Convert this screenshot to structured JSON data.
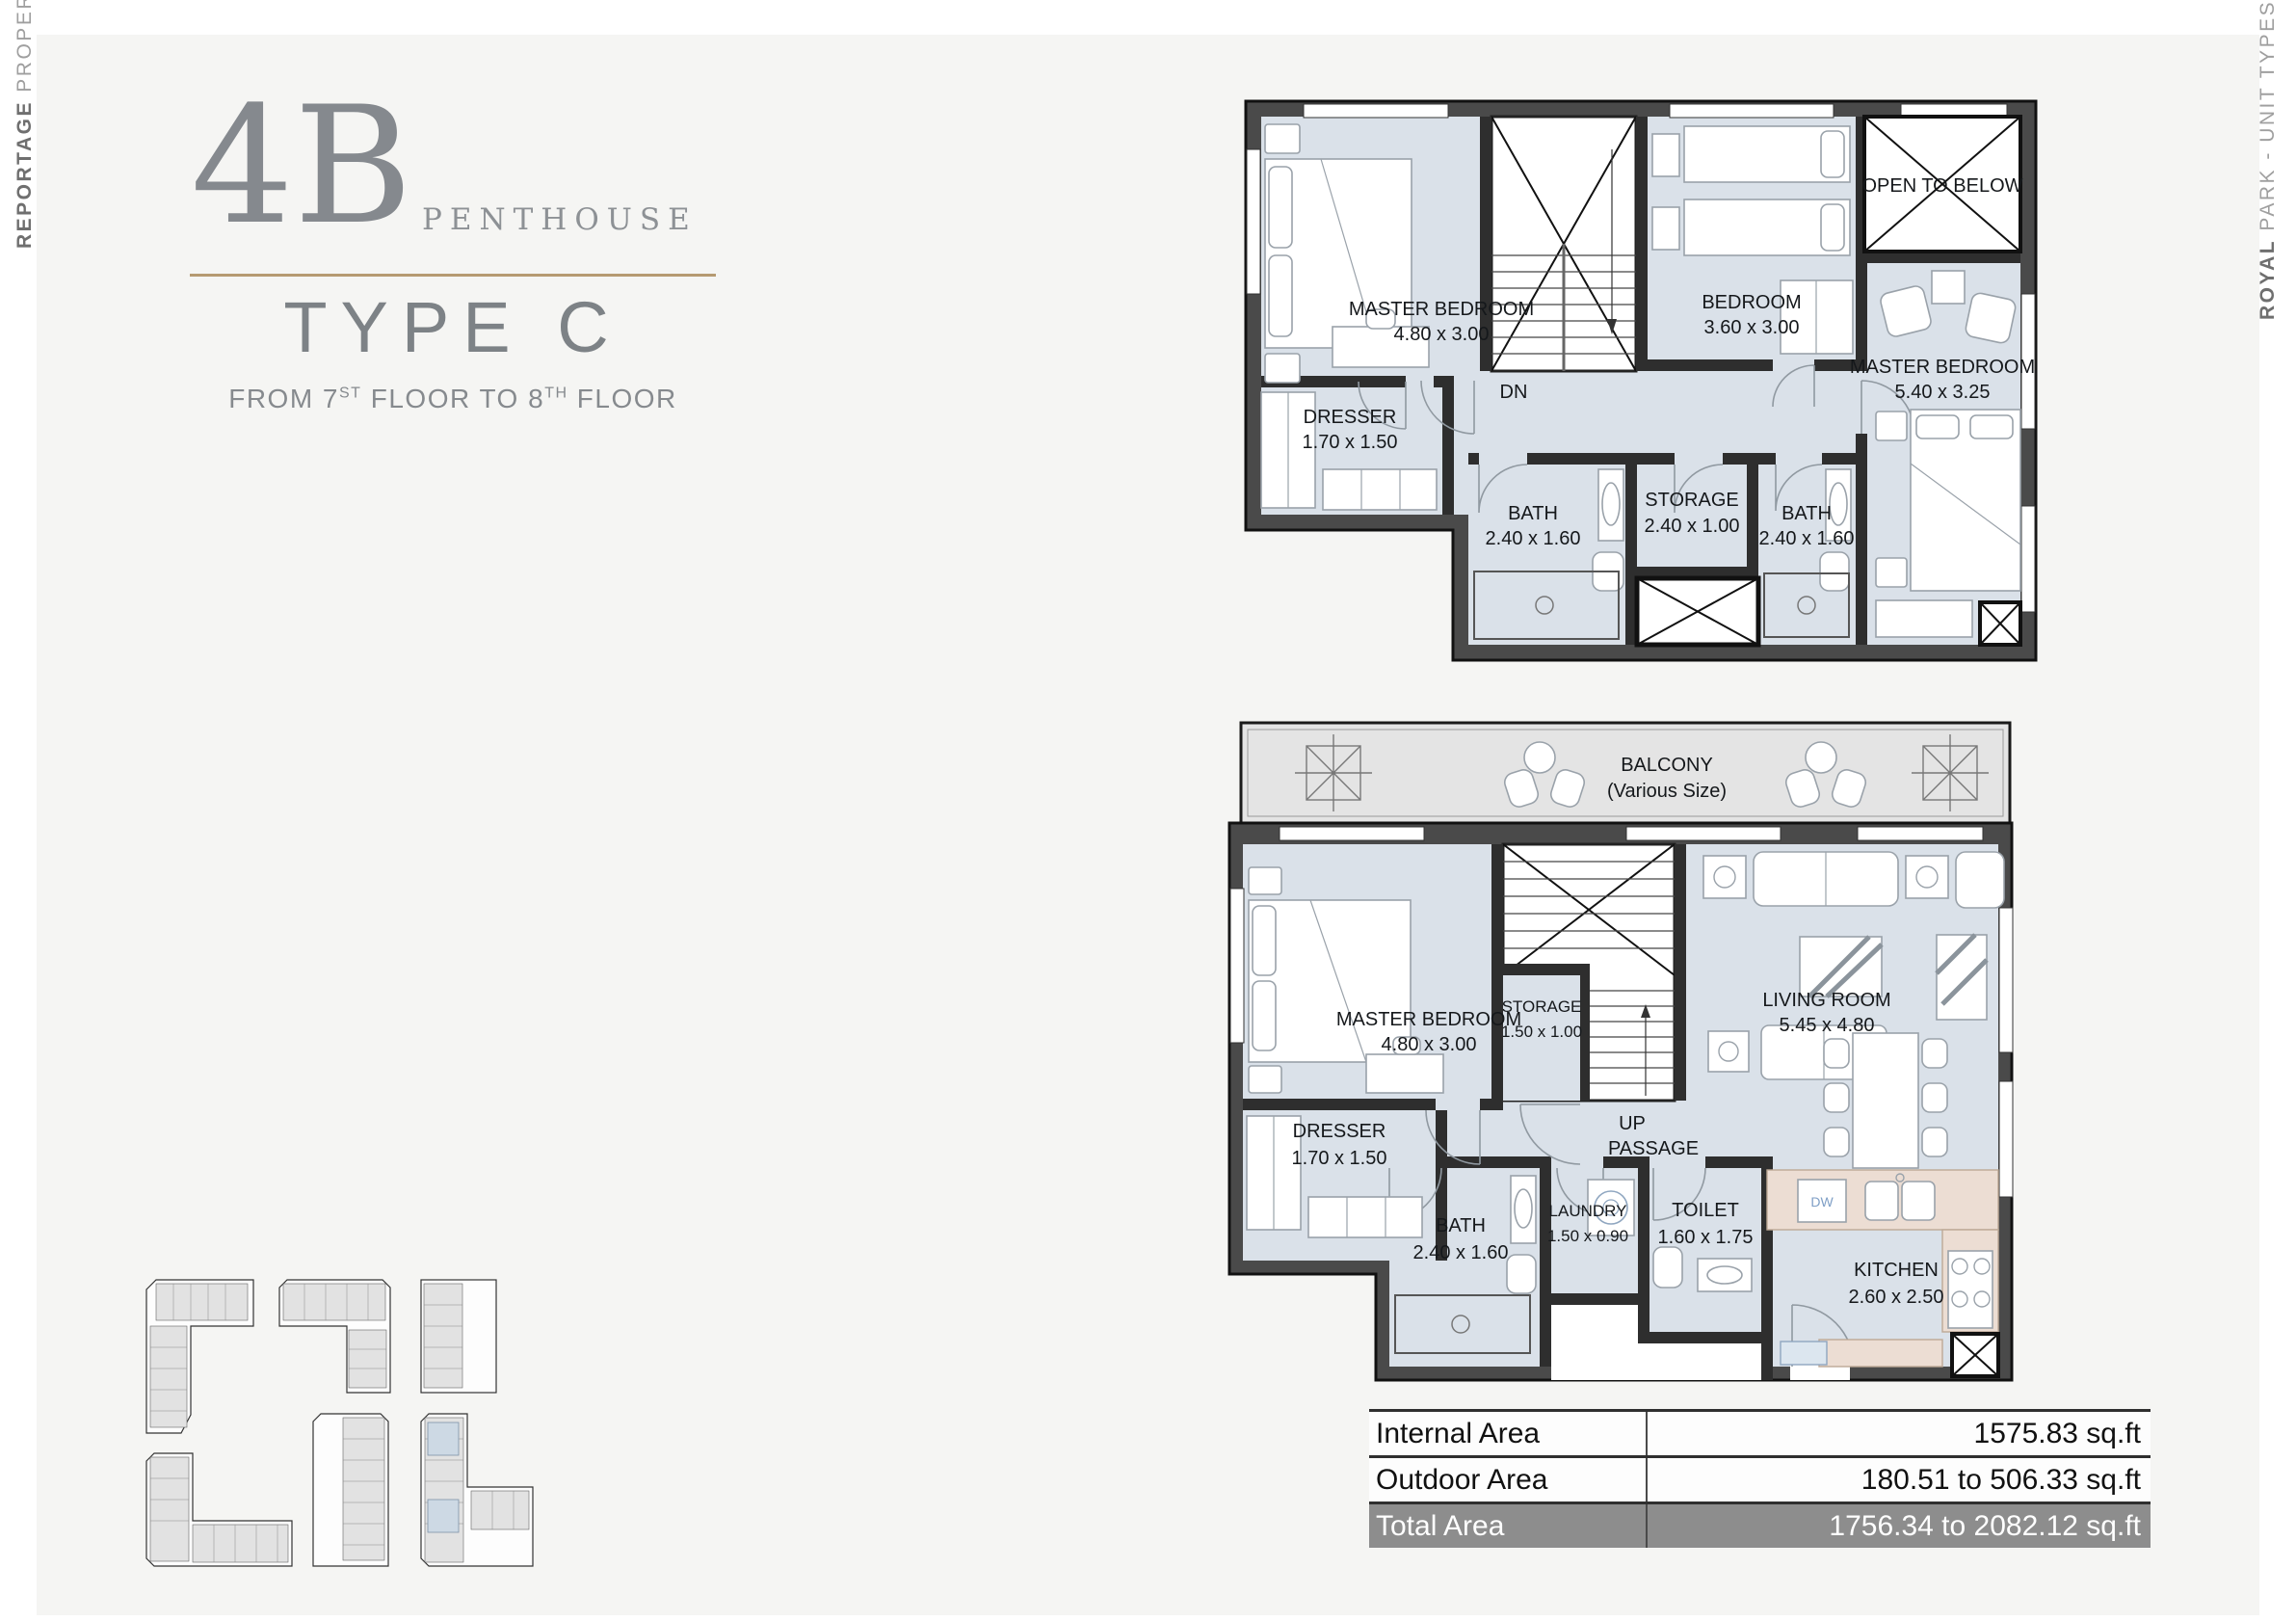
{
  "brand_left": {
    "bold": "REPORTAGE",
    "light": " PROPERTIES"
  },
  "brand_right": {
    "bold": "ROYAL",
    "light": " PARK - UNIT TYPES"
  },
  "title": {
    "code": "4B",
    "category": "PENTHOUSE",
    "type_label": "TYPE C",
    "floor_from_prefix": "FROM 7",
    "floor_sup1": "ST",
    "floor_mid": " FLOOR TO 8",
    "floor_sup2": "TH",
    "floor_tail": " FLOOR"
  },
  "upper_floor": {
    "stair": "DN",
    "rooms": {
      "master1": {
        "name": "MASTER BEDROOM",
        "dims": "4.80 x 3.00"
      },
      "bedroom": {
        "name": "BEDROOM",
        "dims": "3.60 x 3.00"
      },
      "open_below": {
        "name": "OPEN TO BELOW"
      },
      "master2": {
        "name": "MASTER BEDROOM",
        "dims": "5.40 x 3.25"
      },
      "dresser": {
        "name": "DRESSER",
        "dims": "1.70 x 1.50"
      },
      "bath1": {
        "name": "BATH",
        "dims": "2.40 x 1.60"
      },
      "storage": {
        "name": "STORAGE",
        "dims": "2.40 x 1.00"
      },
      "bath2": {
        "name": "BATH",
        "dims": "2.40 x 1.60"
      }
    }
  },
  "lower_floor": {
    "stair": "UP",
    "rooms": {
      "balcony": {
        "name": "BALCONY",
        "dims": "(Various Size)"
      },
      "master": {
        "name": "MASTER BEDROOM",
        "dims": "4.80 x 3.00"
      },
      "storage": {
        "name": "STORAGE",
        "dims": "1.50 x 1.00"
      },
      "living": {
        "name": "LIVING ROOM",
        "dims": "5.45 x 4.80"
      },
      "passage": {
        "name": "PASSAGE"
      },
      "dresser": {
        "name": "DRESSER",
        "dims": "1.70 x 1.50"
      },
      "bath": {
        "name": "BATH",
        "dims": "2.40 x 1.60"
      },
      "laundry": {
        "name": "LAUNDRY",
        "dims": "1.50 x 0.90"
      },
      "toilet": {
        "name": "TOILET",
        "dims": "1.60 x 1.75"
      },
      "kitchen": {
        "name": "KITCHEN",
        "dims": "2.60 x 2.50"
      }
    }
  },
  "area_table": {
    "rows": [
      {
        "label": "Internal Area",
        "value": "1575.83 sq.ft"
      },
      {
        "label": "Outdoor Area",
        "value": "180.51 to 506.33 sq.ft"
      },
      {
        "label": "Total Area",
        "value": "1756.34 to 2082.12 sq.ft"
      }
    ]
  },
  "colors": {
    "accent_gold": "#b59a71",
    "floor_fill": "#dae1e9",
    "balcony_fill": "#e4e4e4",
    "wall": "#2e2e2e",
    "kitchen_counter": "#ecddd3",
    "highlight_unit": "#cdd9e4",
    "total_row_bg": "#8d8d8d"
  }
}
